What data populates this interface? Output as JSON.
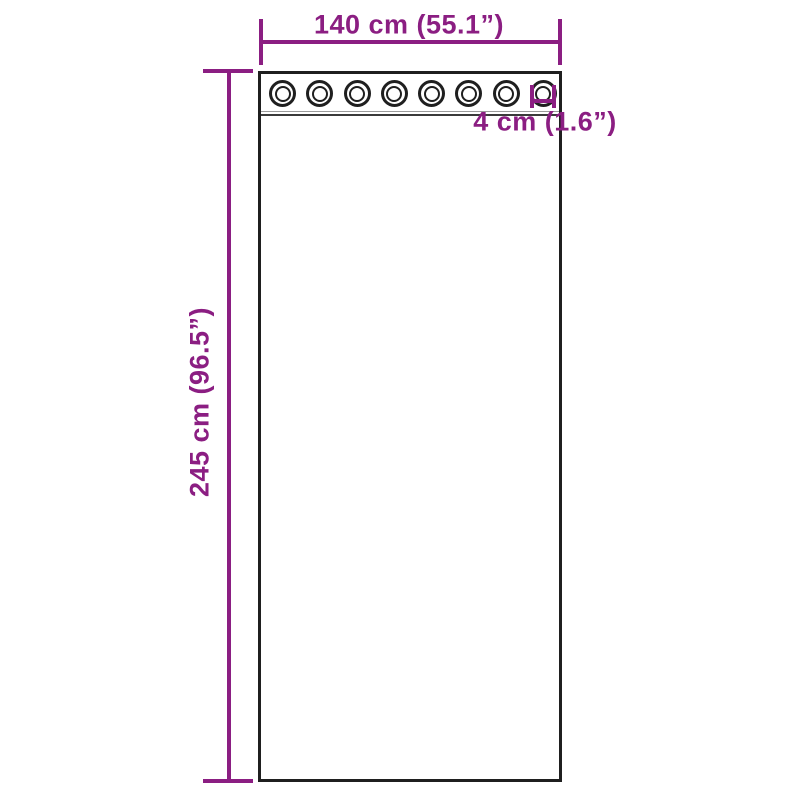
{
  "diagram": {
    "dimensions": {
      "width_label": "140 cm (55.1”)",
      "height_label": "245 cm (96.5”)",
      "grommet_label": "4 cm (1.6”)"
    },
    "grommets": {
      "count": 8
    },
    "colors": {
      "dimension": "#8B1E82",
      "outline": "#1F1F1F",
      "seam-light": "#9A9A9A",
      "seam-dark": "#3A3A3A",
      "background": "#FFFFFF"
    }
  }
}
